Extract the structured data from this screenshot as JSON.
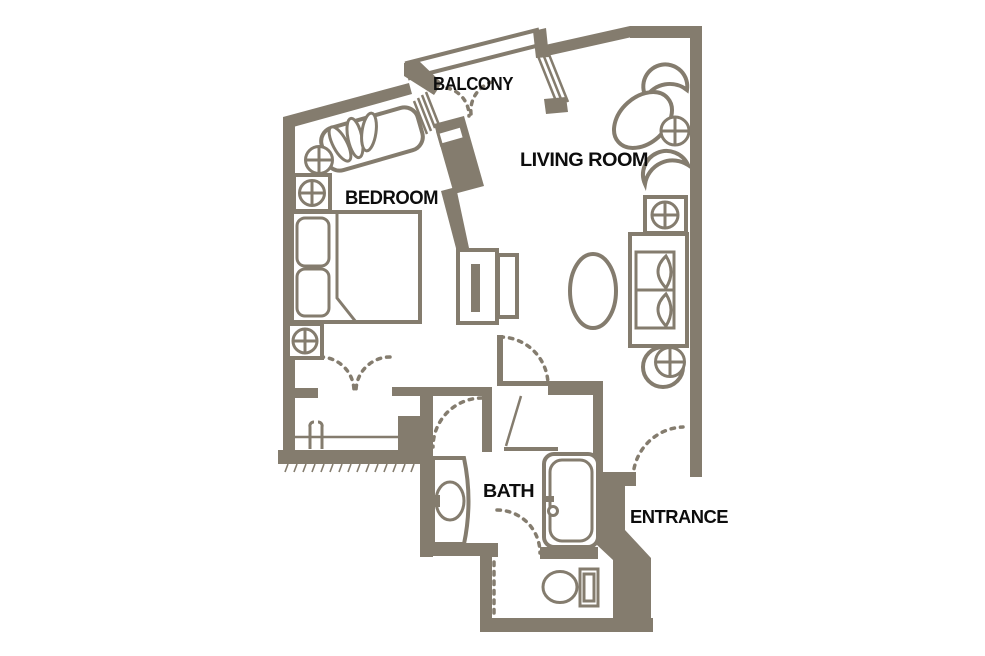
{
  "title": "Hotel suite floor plan",
  "colors": {
    "wall": "#847c6e",
    "label": "#0d0d0d",
    "background": "#ffffff"
  },
  "rooms": {
    "balcony": "BALCONY",
    "living_room": "LIVING ROOM",
    "bedroom": "BEDROOM",
    "bath": "BATH",
    "entrance": "ENTRANCE"
  }
}
